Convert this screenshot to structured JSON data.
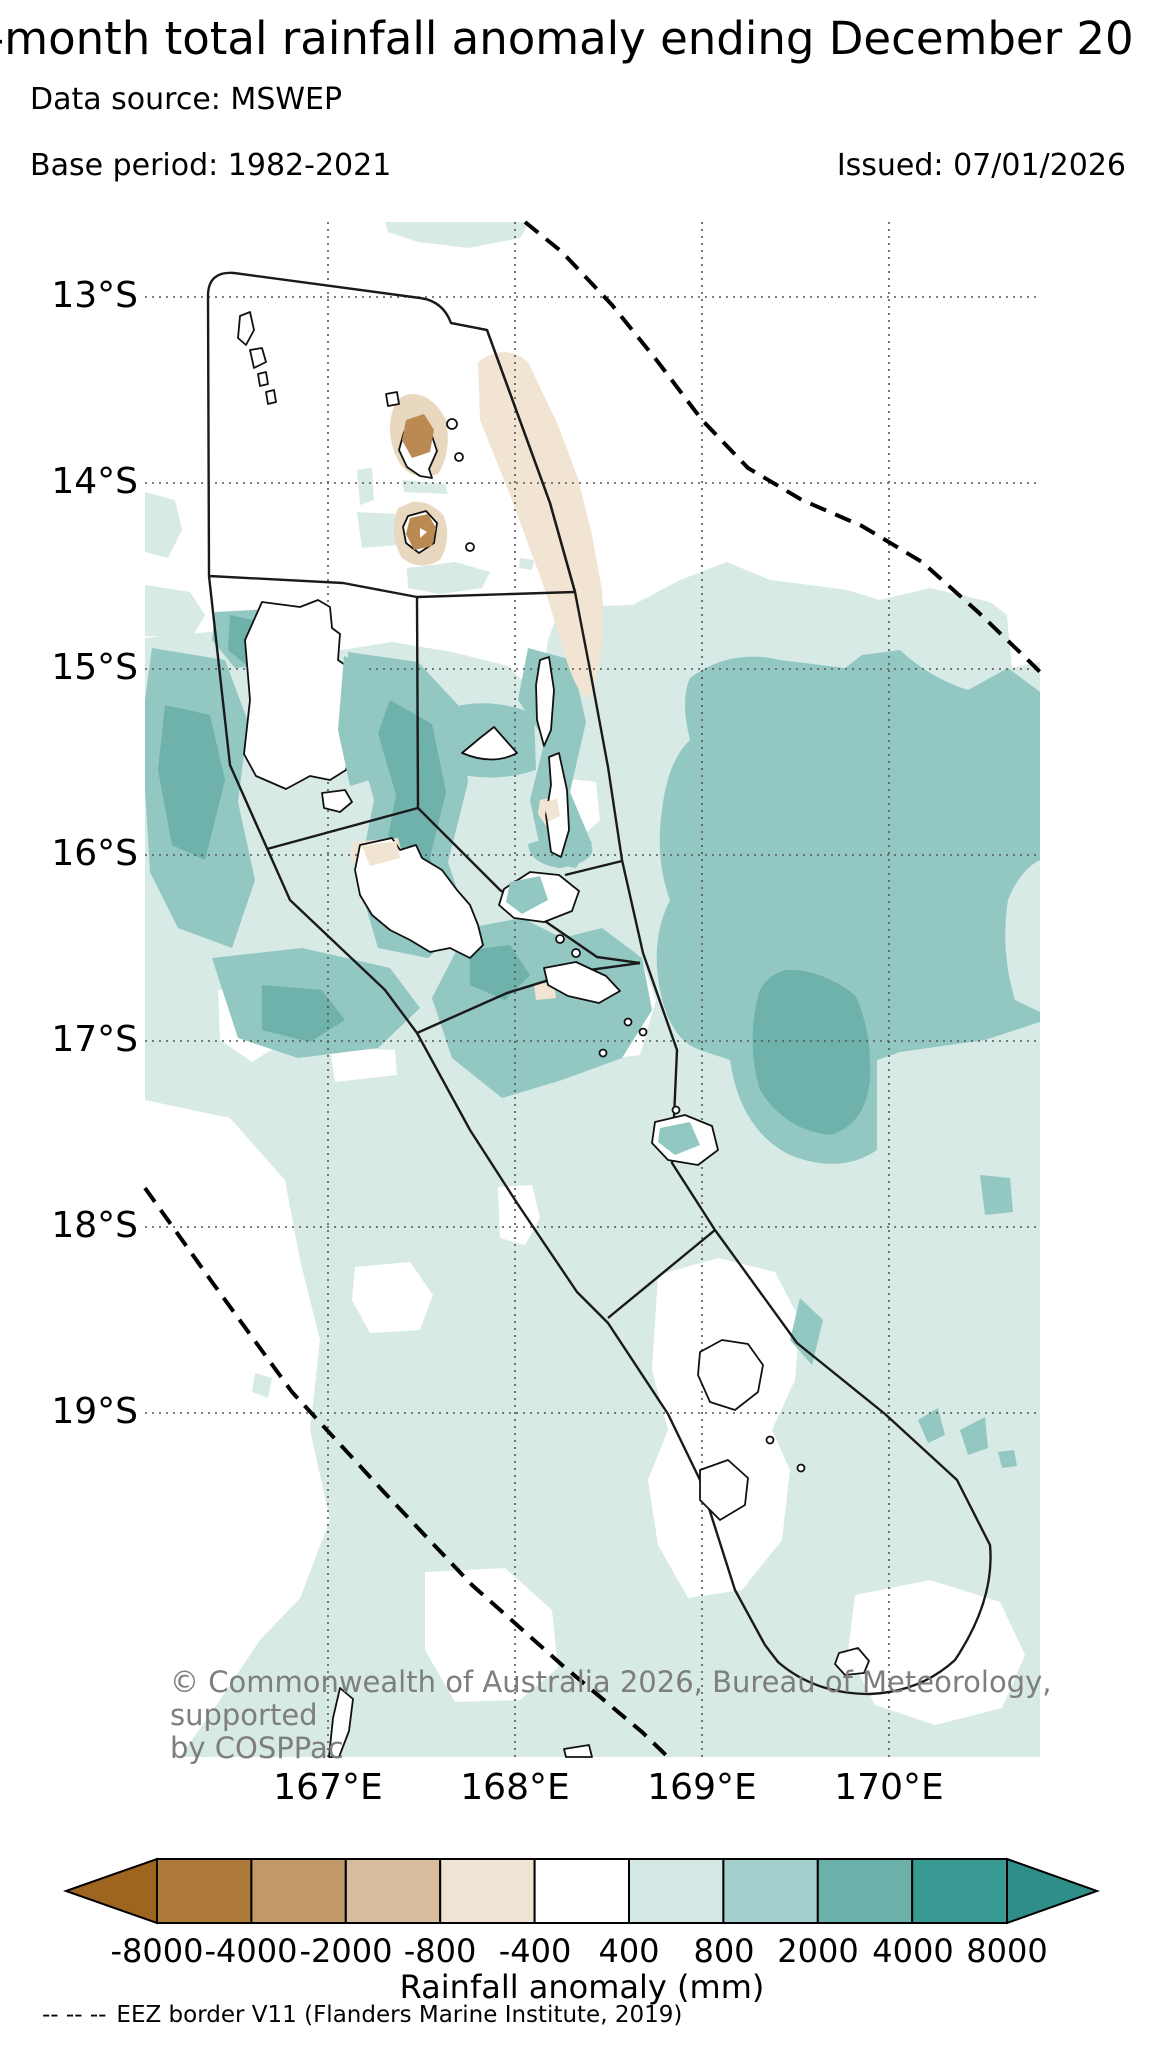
{
  "header": {
    "title": "-month total rainfall anomaly ending December 20",
    "data_source": "Data source: MSWEP",
    "base_period": "Base period: 1982-2021",
    "issued": "Issued: 07/01/2026"
  },
  "map": {
    "lat_labels": [
      "13°S",
      "14°S",
      "15°S",
      "16°S",
      "17°S",
      "18°S",
      "19°S"
    ],
    "lon_labels": [
      "167°E",
      "168°E",
      "169°E",
      "170°E"
    ],
    "copyright_line1": "© Commonwealth of Australia 2026, Bureau of Meteorology, supported",
    "copyright_line2": "by COSPPac"
  },
  "palette": {
    "light": "#d7eae6",
    "mid": "#93c7c2",
    "dark": "#6fb1ab",
    "tan_light": "#f2e4d3",
    "tan_ring": "#e9d8c0",
    "brown_core": "#bb8a52",
    "white": "#ffffff",
    "grid": "#555555",
    "border": "#1a1a1a",
    "eez": "#000000"
  },
  "colorbar": {
    "tick_labels": [
      "-8000",
      "-4000",
      "-2000",
      "-800",
      "-400",
      "400",
      "800",
      "2000",
      "4000",
      "8000"
    ],
    "title": "Rainfall anomaly (mm)",
    "colors": [
      "#9d6520",
      "#ae7a39",
      "#c29968",
      "#d7bc9d",
      "#efe3d3",
      "#ffffff",
      "#d3e8e4",
      "#a3d0cc",
      "#6cb0aa",
      "#389a93",
      "#2f8e88"
    ]
  },
  "footer": {
    "symbol": "-- -- --",
    "text": "EEZ border V11 (Flanders Marine Institute, 2019)"
  }
}
